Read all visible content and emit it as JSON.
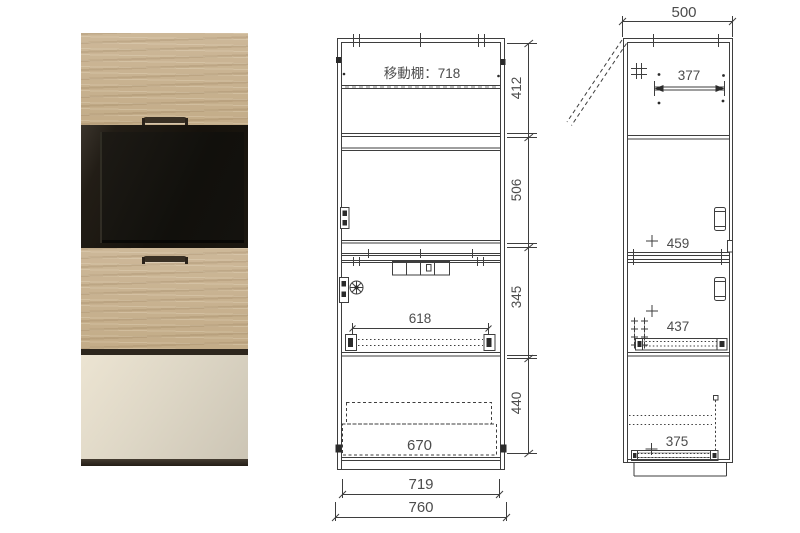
{
  "colors": {
    "background": "#ffffff",
    "drawing_line": "#3e3e3e",
    "dimension_text": "#4c4c4c",
    "wood": "#c9b494",
    "glass_door": "#1a160f",
    "tv_screen": "#12100d",
    "light_drawer": "#ded7c7",
    "dark_accent": "#2d261d"
  },
  "front_view": {
    "shelf_label": "移動棚：718",
    "height_top": "412",
    "height_middle": "506",
    "height_lower": "345",
    "height_bottom": "440",
    "slide_width": "618",
    "drawer_width": "670",
    "inner_width": "719",
    "outer_width": "760"
  },
  "side_view": {
    "depth": "500",
    "shelf_depth": "377",
    "upper_door_depth": "459",
    "slide_depth": "437",
    "drawer_depth": "375"
  }
}
